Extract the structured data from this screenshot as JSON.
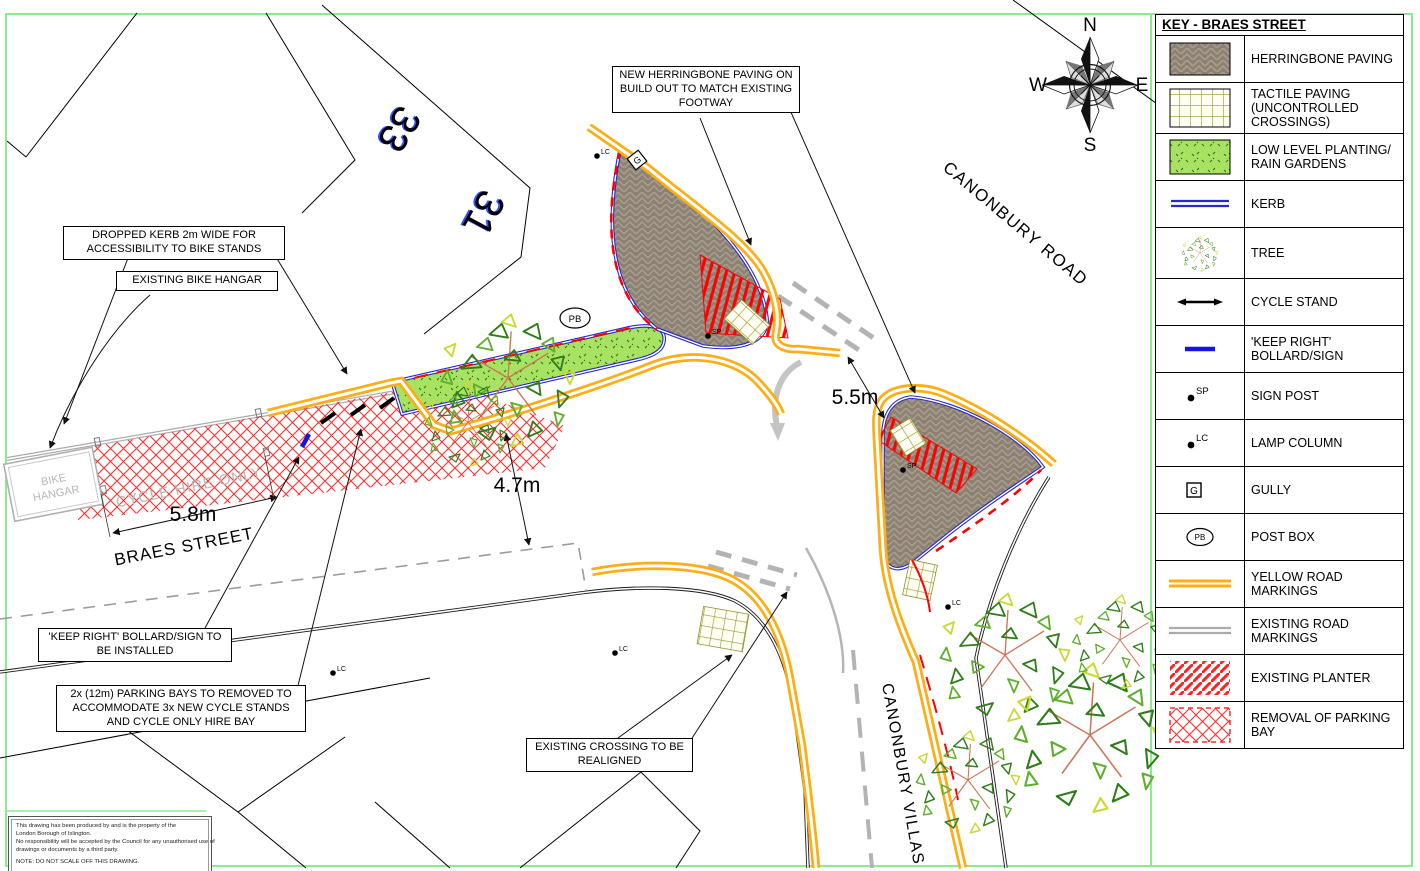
{
  "legend": {
    "title": "KEY - BRAES STREET",
    "items": [
      {
        "id": "herringbone",
        "label": "HERRINGBONE PAVING"
      },
      {
        "id": "tactile",
        "label": "TACTILE PAVING (UNCONTROLLED CROSSINGS)"
      },
      {
        "id": "planting",
        "label": "LOW LEVEL PLANTING/ RAIN GARDENS"
      },
      {
        "id": "kerb",
        "label": "KERB"
      },
      {
        "id": "tree",
        "label": "TREE"
      },
      {
        "id": "cycle-stand",
        "label": "CYCLE STAND"
      },
      {
        "id": "keep-right",
        "label": "'KEEP RIGHT' BOLLARD/SIGN"
      },
      {
        "id": "sign-post",
        "label": "SIGN POST"
      },
      {
        "id": "lamp-column",
        "label": "LAMP COLUMN"
      },
      {
        "id": "gully",
        "label": "GULLY"
      },
      {
        "id": "post-box",
        "label": "POST BOX"
      },
      {
        "id": "yellow-road-markings",
        "label": "YELLOW ROAD MARKINGS"
      },
      {
        "id": "existing-road-markings",
        "label": "EXISTING ROAD MARKINGS"
      },
      {
        "id": "existing-planter",
        "label": "EXISTING PLANTER"
      },
      {
        "id": "removal-of-parking-bay",
        "label": "REMOVAL OF PARKING BAY"
      }
    ]
  },
  "callouts": {
    "herringbone": "NEW HERRINGBONE PAVING ON BUILD OUT TO MATCH EXISTING FOOTWAY",
    "dropped_kerb": "DROPPED KERB 2m WIDE FOR ACCESSIBILITY TO BIKE STANDS",
    "bike_hangar": "EXISTING BIKE HANGAR",
    "keep_right": "'KEEP RIGHT' BOLLARD/SIGN TO BE INSTALLED",
    "parking_bays": "2x (12m) PARKING BAYS TO REMOVED TO ACCOMMODATE 3x NEW CYCLE STANDS AND CYCLE ONLY HIRE BAY",
    "crossing": "EXISTING CROSSING TO BE REALIGNED"
  },
  "dimensions": {
    "bay_length": "5.8m",
    "crossing_width": "4.7m",
    "junction_mouth": "5.5m"
  },
  "streets": {
    "canonbury_road": "CANONBURY ROAD",
    "braes_street": "BRAES STREET",
    "canonbury_villas": "CANONBURY VILLAS"
  },
  "map_labels": {
    "bike_hangar_line1": "BIKE",
    "bike_hangar_line2": "HANGAR",
    "cycle_hire": "CYCLE HIRE ONLY",
    "post_box": "PB",
    "gully": "G",
    "sign_post": "SP",
    "lamp_column": "LC",
    "building_33": "33",
    "building_31": "31"
  },
  "compass": {
    "n": "N",
    "e": "E",
    "s": "S",
    "w": "W"
  },
  "note": {
    "line1": "This drawing has been produced by and is the property of the",
    "line2": "London Borough of Islington.",
    "line3": "No responsibility will be accepted by the Council for any unauthorised use of",
    "line4": "drawings or documents by a third party.",
    "note_line": "NOTE: DO NOT SCALE OFF THIS DRAWING."
  },
  "colors": {
    "frame_green": "#8CEB8C",
    "yellow_marking": "#FBAE17",
    "kerb_blue": "#2929C8",
    "red": "#FF2D2D",
    "herringbone_grey": "#8C8173",
    "planting_green": "#A7E262",
    "existing_grey": "#ABABAB"
  }
}
